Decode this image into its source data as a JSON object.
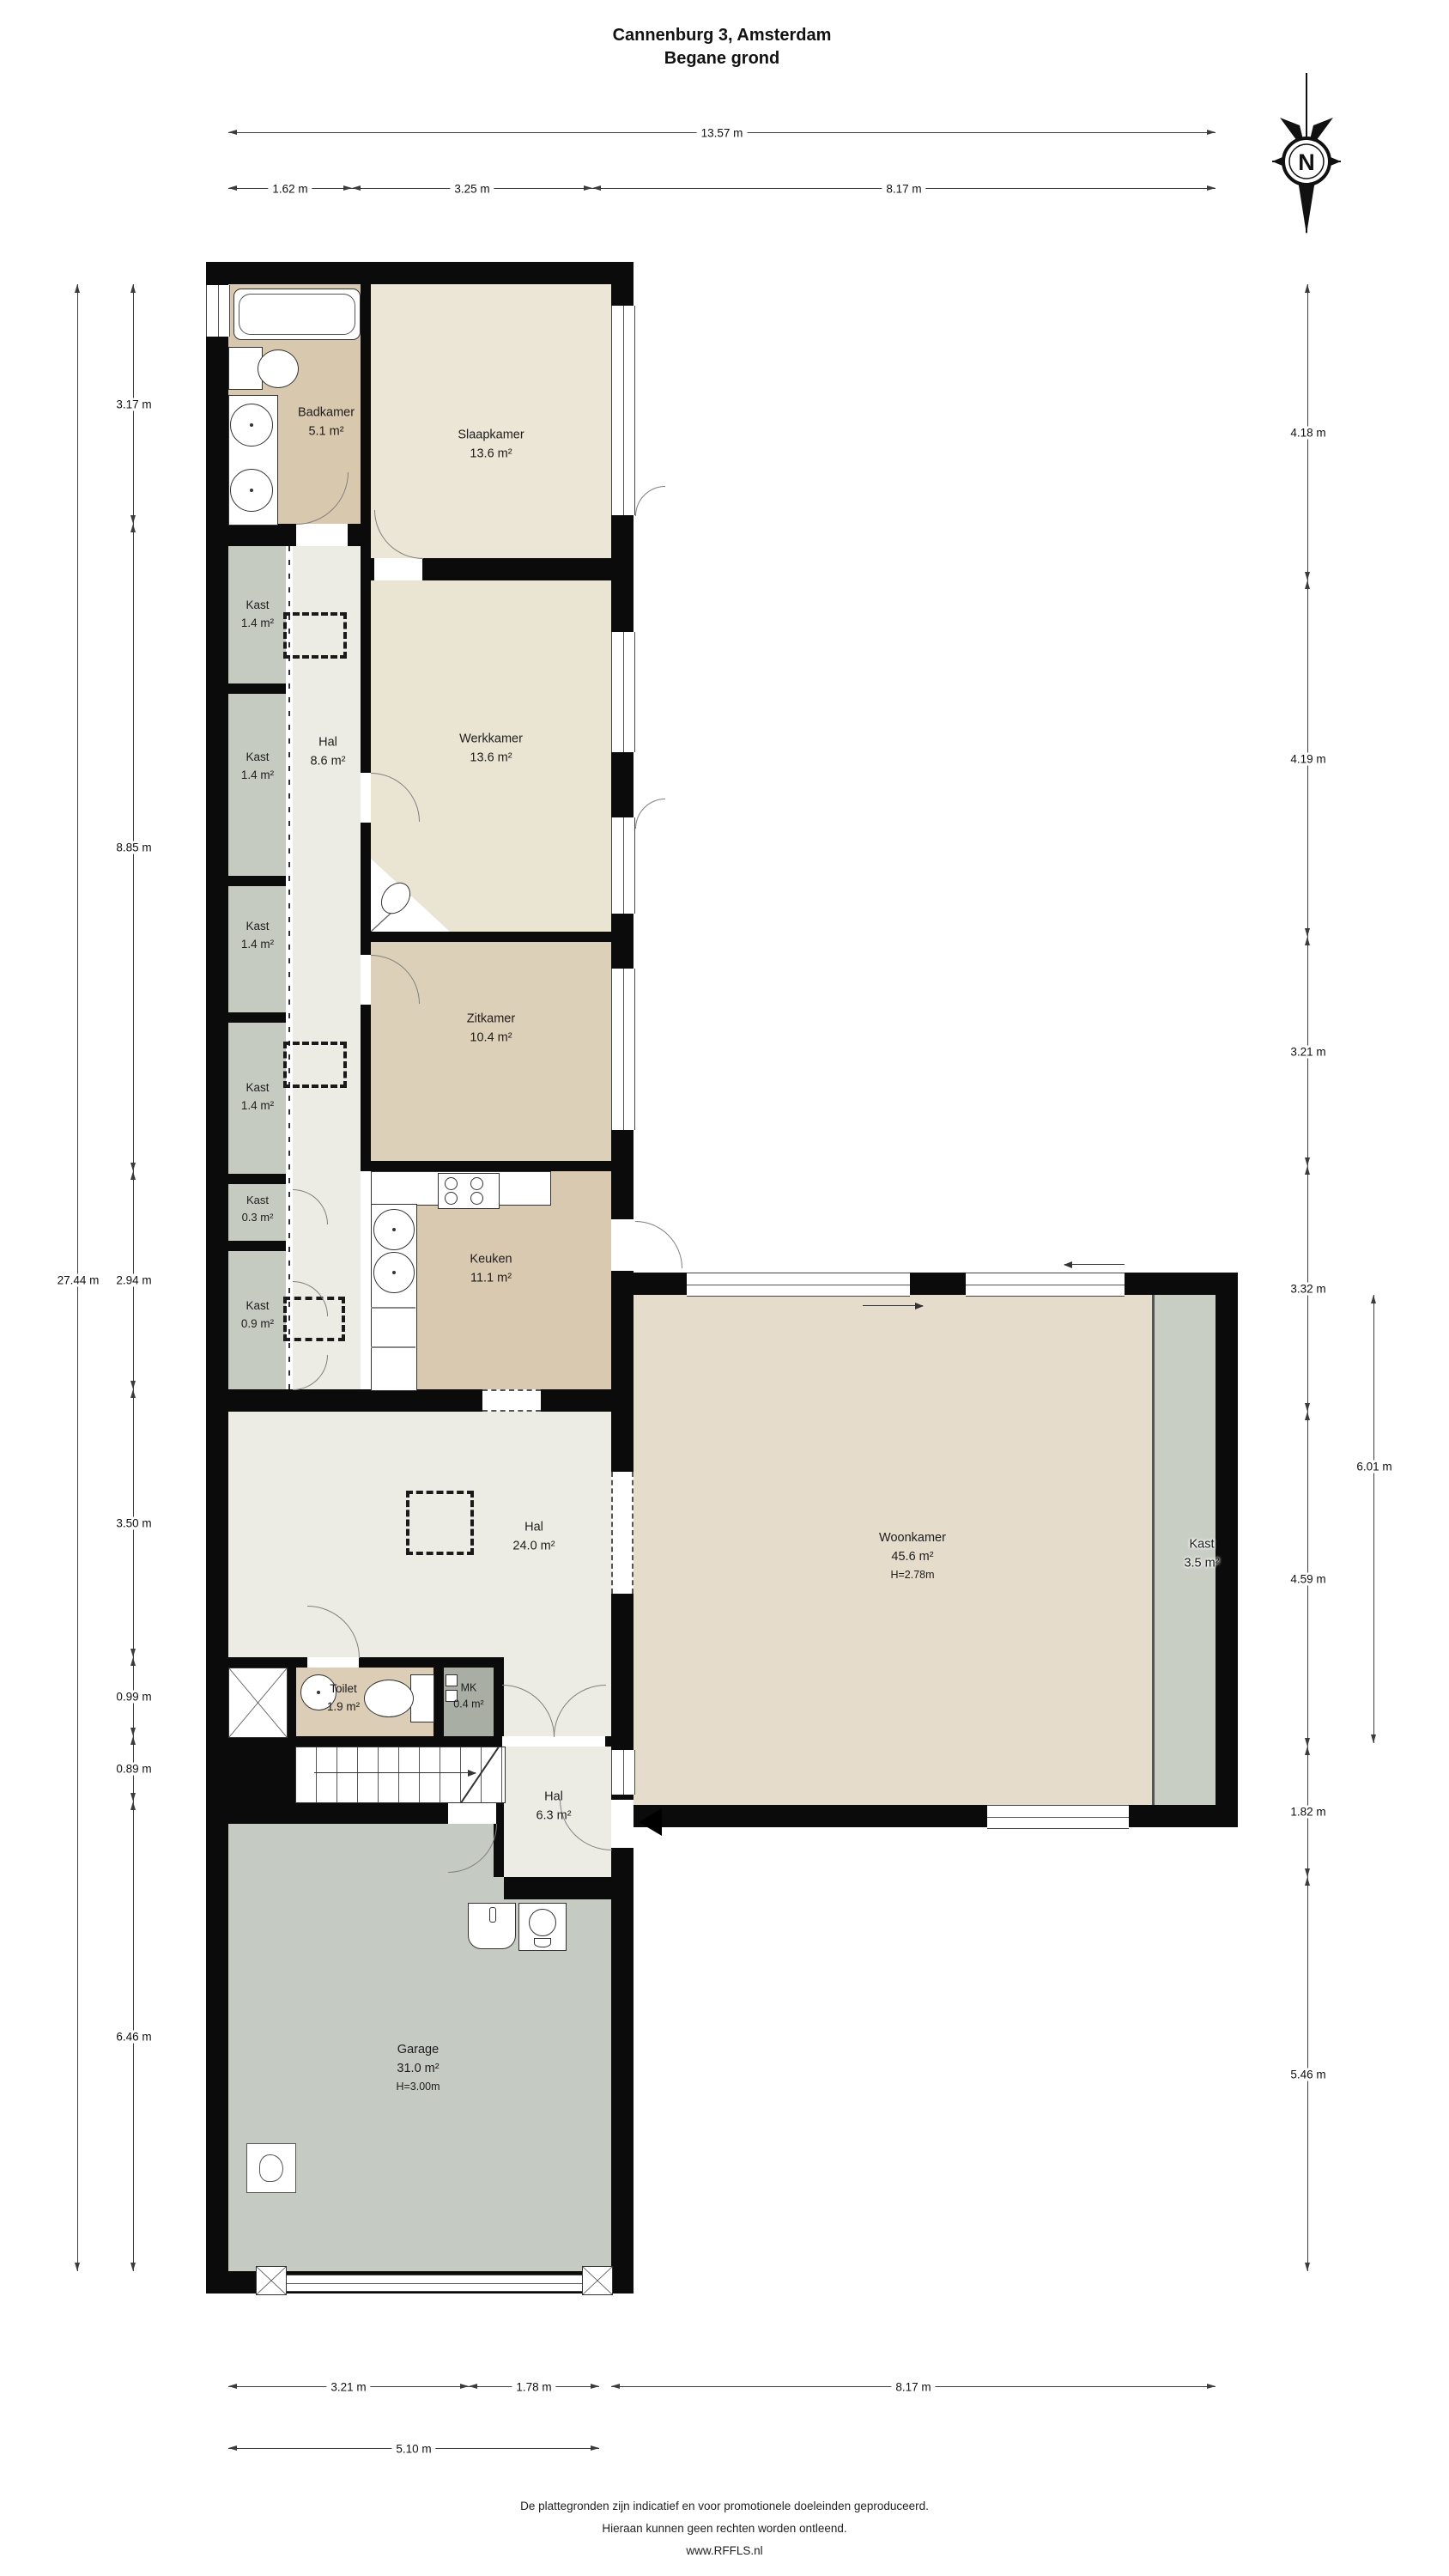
{
  "title": {
    "line1": "Cannenburg 3, Amsterdam",
    "line2": "Begane grond"
  },
  "compass_letter": "N",
  "dims": {
    "top_total": "13.57 m",
    "top_segments": [
      "1.62 m",
      "3.25 m",
      "8.17 m"
    ],
    "left_total": "27.44 m",
    "left_segments": [
      "3.17 m",
      "8.85 m",
      "2.94 m",
      "3.50 m",
      "0.99 m",
      "0.89 m",
      "6.46 m"
    ],
    "right_segments": [
      "4.18 m",
      "4.19 m",
      "3.21 m",
      "3.32 m",
      "4.59 m",
      "1.82 m",
      "5.46 m"
    ],
    "woonkamer_inner": "6.01 m",
    "bottom_segments": [
      "3.21 m",
      "1.78 m",
      "8.17 m"
    ],
    "bottom_total": "5.10 m"
  },
  "rooms": {
    "badkamer": {
      "name": "Badkamer",
      "area": "5.1 m²"
    },
    "slaapkamer": {
      "name": "Slaapkamer",
      "area": "13.6 m²"
    },
    "werkkamer": {
      "name": "Werkkamer",
      "area": "13.6 m²"
    },
    "zitkamer": {
      "name": "Zitkamer",
      "area": "10.4 m²"
    },
    "keuken": {
      "name": "Keuken",
      "area": "11.1 m²"
    },
    "hal_corridor": {
      "name": "Hal",
      "area": "8.6 m²"
    },
    "hal_centraal": {
      "name": "Hal",
      "area": "24.0 m²"
    },
    "hal_entree": {
      "name": "Hal",
      "area": "6.3 m²"
    },
    "woonkamer": {
      "name": "Woonkamer",
      "area": "45.6 m²",
      "height": "H=2.78m"
    },
    "kast_woonkamer": {
      "name": "Kast",
      "area": "3.5 m²"
    },
    "toilet": {
      "name": "Toilet",
      "area": "1.9 m²"
    },
    "mk": {
      "name": "MK",
      "area": "0.4 m²"
    },
    "garage": {
      "name": "Garage",
      "area": "31.0 m²",
      "height": "H=3.00m"
    },
    "kasten": [
      {
        "name": "Kast",
        "area": "1.4 m²"
      },
      {
        "name": "Kast",
        "area": "1.4 m²"
      },
      {
        "name": "Kast",
        "area": "1.4 m²"
      },
      {
        "name": "Kast",
        "area": "1.4 m²"
      },
      {
        "name": "Kast",
        "area": "0.3 m²"
      },
      {
        "name": "Kast",
        "area": "0.9 m²"
      }
    ]
  },
  "footer": {
    "line1": "De plattegronden zijn indicatief en voor promotionele doeleinden geproduceerd.",
    "line2": "Hieraan kunnen geen rechten worden ontleend.",
    "line3": "www.RFFLS.nl"
  }
}
